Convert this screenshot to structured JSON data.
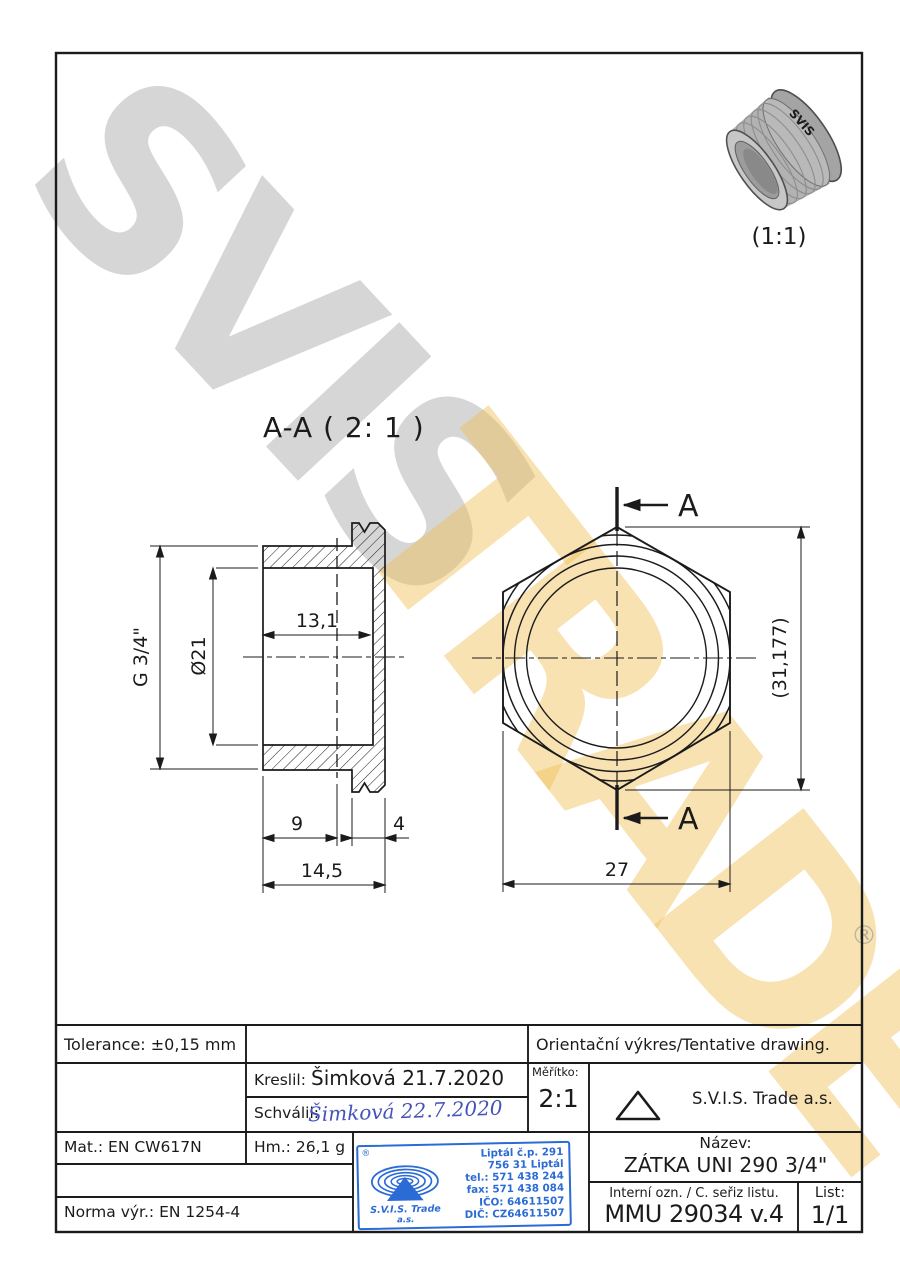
{
  "watermark": {
    "gray": "SVIS",
    "yellow": "TRADE",
    "registered": "®"
  },
  "photo": {
    "caption": "(1:1)",
    "emboss": "SVIS"
  },
  "views": {
    "section_title": "A-A ( 2: 1 )",
    "left": {
      "thread": "G 3/4\"",
      "bore_diameter": "Ø21",
      "bore_depth": "13,1",
      "thread_length": "9",
      "collar_width": "4",
      "overall_length": "14,5"
    },
    "right": {
      "across_corners": "(31,177)",
      "across_flats": "27",
      "cut_label_top": "A",
      "cut_label_bottom": "A"
    }
  },
  "title_block": {
    "tolerance": "Tolerance: ±0,15 mm",
    "note": "Orientační výkres/Tentative drawing.",
    "kreslil_label": "Kreslil:",
    "kreslil_value": "Šimková 21.7.2020",
    "schvalil_label": "Schválil:",
    "schvalil_value": "Šimková 22.7.2020",
    "meritko_label": "Měřítko:",
    "meritko_value": "2:1",
    "company": "S.V.I.S. Trade a.s.",
    "material": "Mat.: EN CW617N",
    "weight": "Hm.: 26,1 g",
    "norma": "Norma výr.: EN 1254-4",
    "nazev_label": "Název:",
    "nazev_value": "ZÁTKA UNI 290 3/4\"",
    "interni_label": "Interní ozn. / C. seřiz listu.",
    "interni_value": "MMU 29034 v.4",
    "list_label": "List:",
    "list_value": "1/1"
  },
  "stamp": {
    "registered": "®",
    "company_line1": "S.V.I.S. Trade",
    "company_line2": "a.s.",
    "address_line1": "Liptál č.p. 291",
    "address_line2": "756 31 Liptál",
    "phone": "tel.: 571 438 244",
    "fax": "fax: 571 438 084",
    "ico": "IČO: 64611507",
    "dic": "DIČ: CZ64611507"
  },
  "colors": {
    "line": "#1b1b1b",
    "stamp_blue": "#2a6bd6",
    "signature_blue": "#4553b8"
  }
}
